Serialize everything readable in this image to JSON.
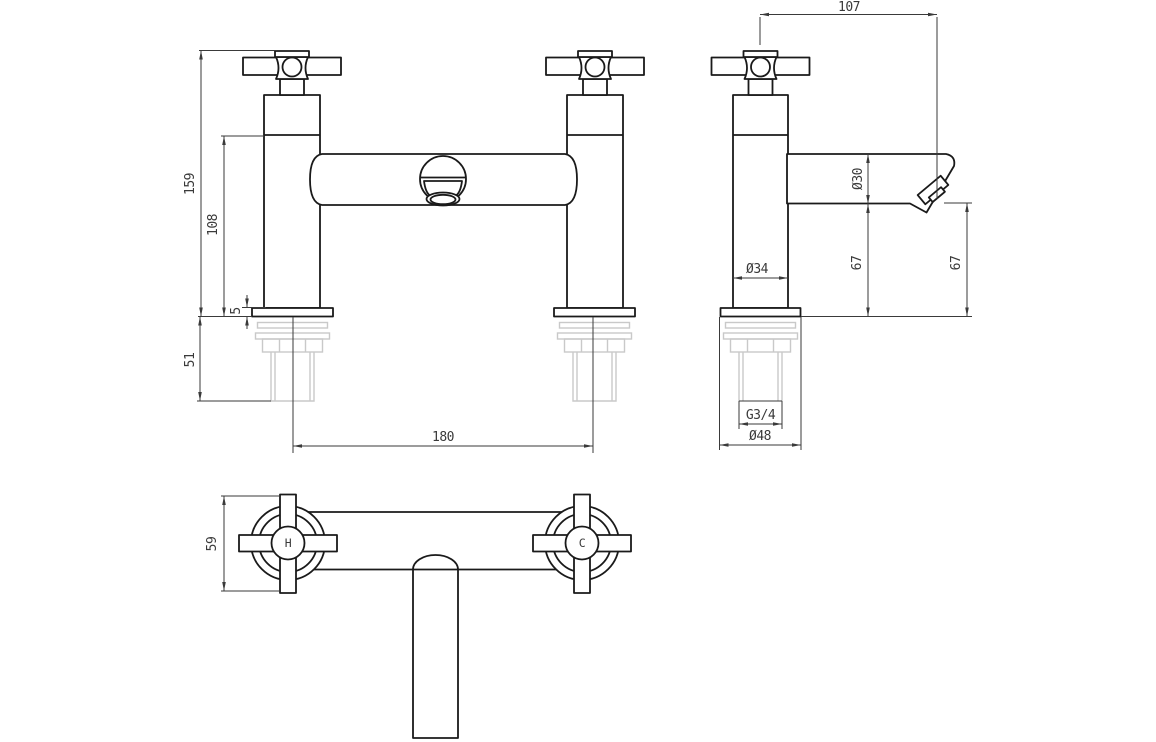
{
  "drawing": {
    "colors": {
      "line": "#1a1a1a",
      "dimension": "#3a3a3a",
      "hidden_hardware": "#c9c9c9",
      "background": "#ffffff"
    },
    "front": {
      "dim_height_total": "159",
      "dim_height_to_body": "108",
      "dim_flange_thickness": "5",
      "dim_tail_length": "51",
      "dim_hole_centres": "180"
    },
    "side": {
      "dim_spout_reach": "107",
      "dim_spout_diameter": "Ø30",
      "dim_body_diameter": "Ø34",
      "dim_spout_clearance": "67",
      "dim_outlet_clearance": "67",
      "dim_thread_size": "G3/4",
      "dim_flange_diameter": "Ø48"
    },
    "plan": {
      "dim_handle_span": "59",
      "hot_label": "H",
      "cold_label": "C"
    }
  }
}
